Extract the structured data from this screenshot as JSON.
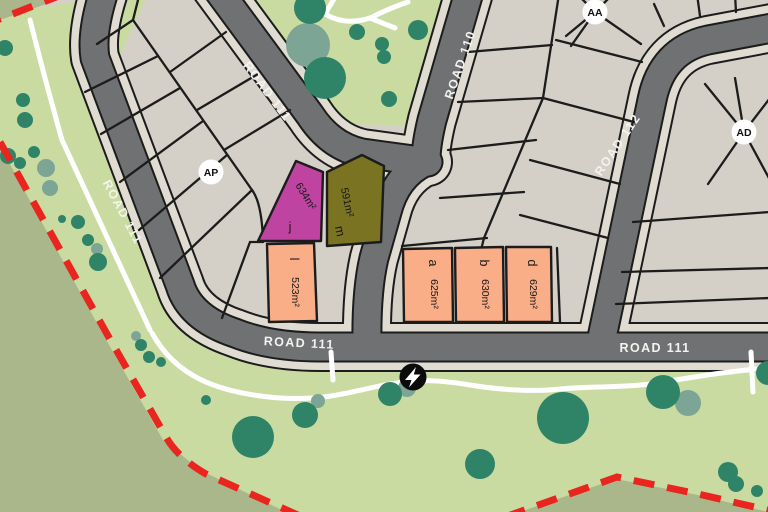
{
  "map": {
    "title": "Estate subdivision plan",
    "road_labels": [
      {
        "text": "ROAD 111",
        "x": 264,
        "y": 94,
        "rotate": 53
      },
      {
        "text": "ROAD 111",
        "x": 119,
        "y": 214,
        "rotate": 62
      },
      {
        "text": "ROAD 111",
        "x": 299,
        "y": 347,
        "rotate": 3
      },
      {
        "text": "ROAD 111",
        "x": 655,
        "y": 352,
        "rotate": 0
      },
      {
        "text": "ROAD 110",
        "x": 464,
        "y": 66,
        "rotate": -71
      },
      {
        "text": "ROAD 112",
        "x": 621,
        "y": 147,
        "rotate": -56
      }
    ],
    "lots": [
      {
        "id": "j",
        "area": "634m²"
      },
      {
        "id": "m",
        "area": "591m²"
      },
      {
        "id": "l",
        "area": "523m²"
      },
      {
        "id": "a",
        "area": "625m²"
      },
      {
        "id": "b",
        "area": "630m²"
      },
      {
        "id": "d",
        "area": "629m²"
      }
    ],
    "markers": [
      {
        "label": "AP"
      },
      {
        "label": "AA"
      },
      {
        "label": "AD"
      }
    ],
    "utility_icon": "power-bolt",
    "colors": {
      "lot_beige": "#d4d0c7",
      "sidewalk": "#e0dcd2",
      "road_gray": "#6f7173",
      "casing_black": "#1c1c1c",
      "park_green": "#c9dba0",
      "sage_green": "#a9b78a",
      "tree_dark": "#2f8468",
      "tree_light": "#7ca595",
      "path_white": "#ffffff",
      "boundary_red": "#e8251f",
      "lot_magenta": "#bf44a1",
      "lot_olive": "#7a7322",
      "lot_salmon": "#f9ae88"
    }
  }
}
